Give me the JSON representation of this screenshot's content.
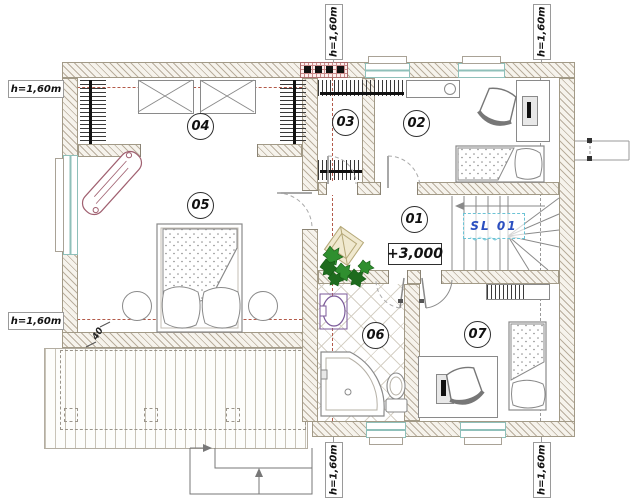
{
  "plan": {
    "rooms": [
      {
        "number": "01"
      },
      {
        "number": "02"
      },
      {
        "number": "03"
      },
      {
        "number": "04"
      },
      {
        "number": "05"
      },
      {
        "number": "06"
      },
      {
        "number": "07"
      }
    ],
    "elevation_marker": "+3,000",
    "stair_label": "SL 01",
    "deck_dimension": "40",
    "height_marks": {
      "left_top": "h=1,60m",
      "left_bottom": "h=1,60m",
      "top_left": "h=1,60m",
      "top_right": "h=1,60m",
      "bottom_left": "h=1,60m",
      "bottom_right": "h=1,60m"
    },
    "colors": {
      "wall_hatch": "#b9ae9d",
      "window_glass": "#8fc0ba",
      "height_line": "#b35a4a",
      "stair_label_text": "#2b4fc0",
      "stair_label_box": "#6cc3d5",
      "chimney_hatch": "#c98a8a",
      "plant_green": "#2f8f2f"
    }
  }
}
